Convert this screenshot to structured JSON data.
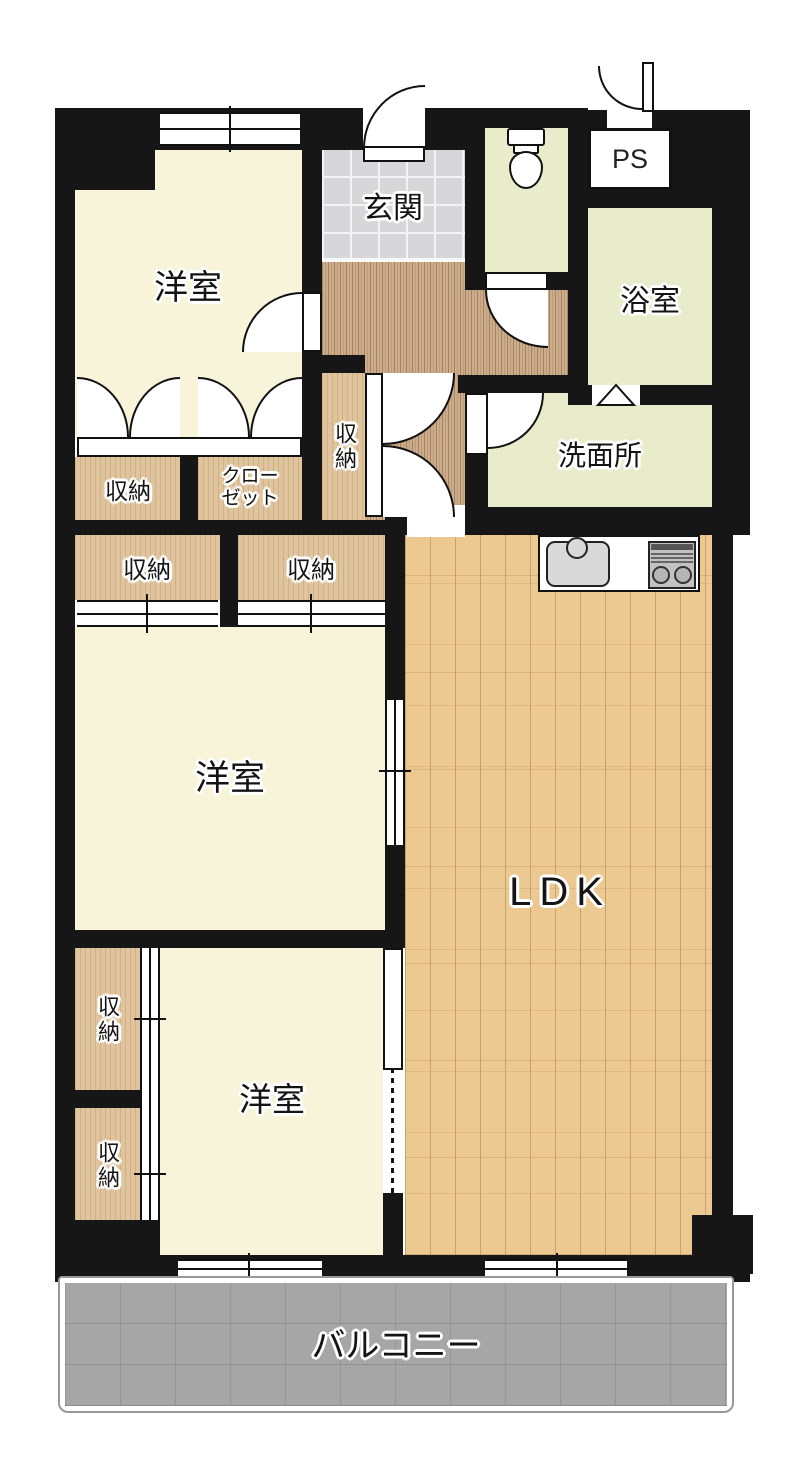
{
  "floorplan": {
    "rooms": {
      "bedroom_top_left": "洋室",
      "bedroom_center": "洋室",
      "bedroom_bottom": "洋室",
      "entrance": "玄関",
      "pipe_space": "PS",
      "bathroom": "浴室",
      "washroom": "洗面所",
      "ldk": "LDK",
      "balcony": "バルコニー"
    },
    "storage": {
      "label": "収納",
      "closet_line1": "クロー",
      "closet_line2": "ゼット"
    },
    "colors": {
      "wall": "#161616",
      "bedroom_fill": "#f8f4da",
      "wet_area_fill": "#e9ecca",
      "storage_wood": "#dfc49e",
      "hallway_wood": "#c9ab8c",
      "entrance_tile": "#d7d7da",
      "ldk_wood": "#edc992",
      "balcony_gray": "#a6a6a6"
    }
  }
}
